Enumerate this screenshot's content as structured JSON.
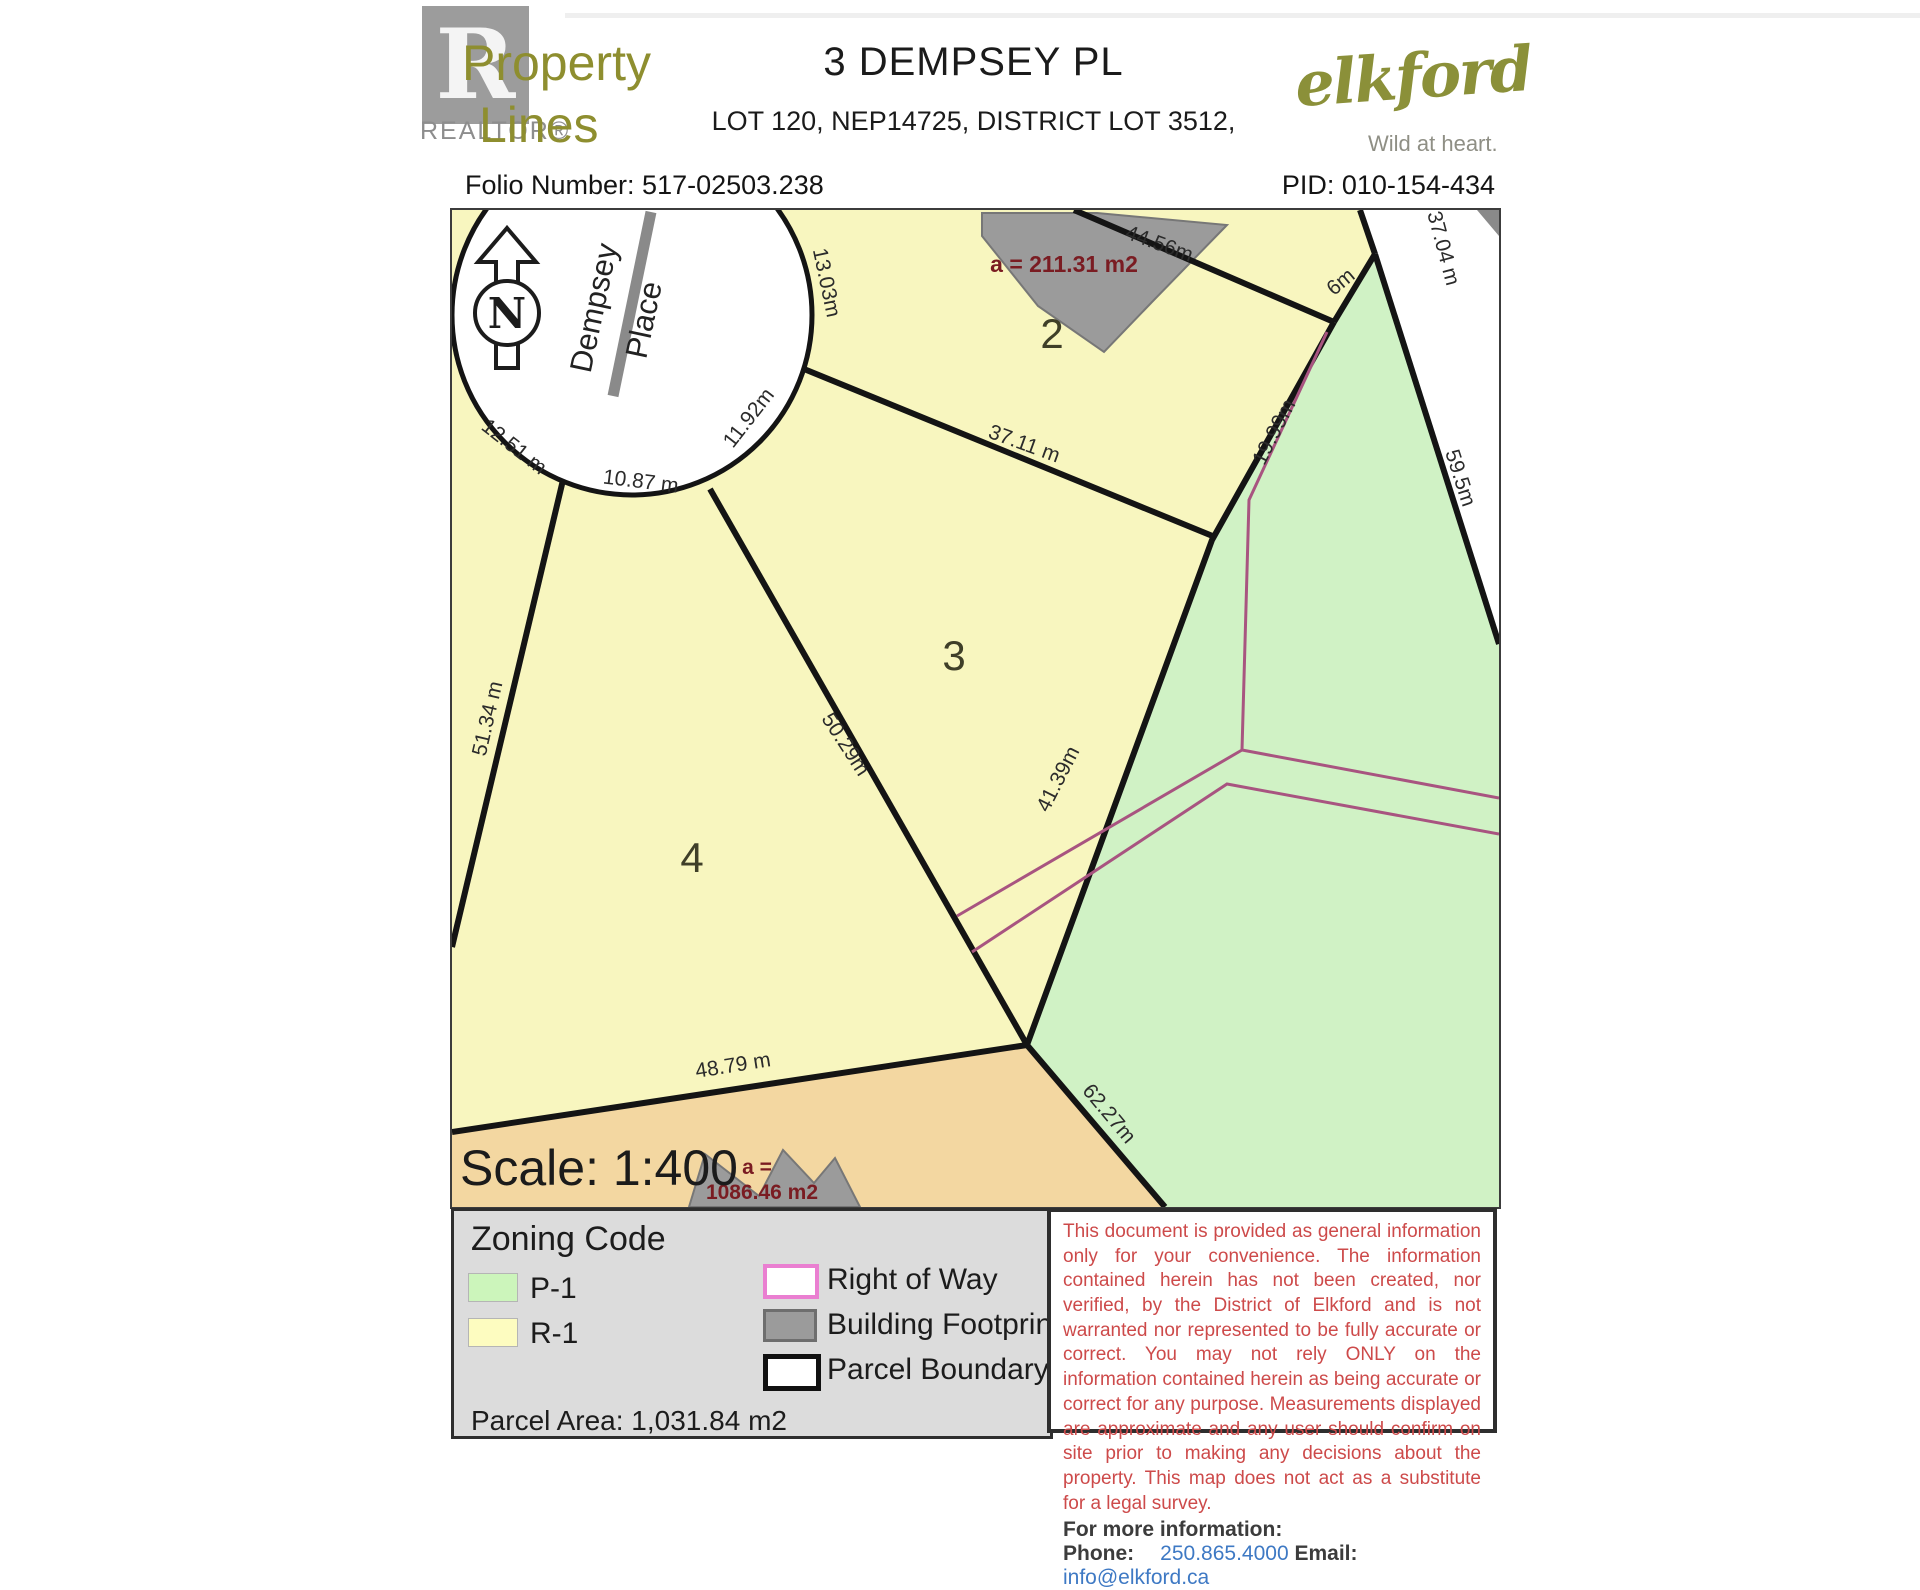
{
  "header": {
    "logo": {
      "brand_top": "Property",
      "brand_bottom": "Lines",
      "realtor_r": "R",
      "realtor_word": "REALTOR®"
    },
    "title": "3 DEMPSEY PL",
    "subtitle": "LOT 120, NEP14725, DISTRICT LOT 3512,",
    "folio": "Folio Number: 517-02503.238",
    "pid": "PID: 010-154-434",
    "municipal_logo": {
      "name": "elkford",
      "tagline": "Wild at heart."
    }
  },
  "map": {
    "north_letter": "N",
    "street_name_line1": "Dempsey",
    "street_name_line2": "Place",
    "scale_text": "Scale: 1:400",
    "parcel_numbers": {
      "p2": "2",
      "p3": "3",
      "p4": "4"
    },
    "building_areas": {
      "top": "a = 211.31 m2",
      "bottom_line1": "a =",
      "bottom_line2": "1086.46 m2"
    },
    "measurements": {
      "arc_1251": "12.51 m",
      "arc_1087": "10.87 m",
      "arc_1192": "11.92m",
      "arc_1303": "13.03m",
      "top_4456": "44.56m",
      "seg_6": "6m",
      "ne_3704": "37.04 m",
      "ne_595": "59.5m",
      "east_1999": "19.99m",
      "mid_3711": "37.11 m",
      "mid_5029": "50.29m",
      "east_4139": "41.39m",
      "west_5134": "51.34 m",
      "south_4879": "48.79 m",
      "se_6227": "62.27m"
    },
    "colors": {
      "zone_r1": "#f8f6bf",
      "zone_p1": "#d0f2c5",
      "unzoned_tan": "#f3d7a1",
      "right_of_way": "#a85480",
      "building": "#9b9b9b",
      "parcel_boundary": "#141414"
    }
  },
  "legend": {
    "zoning_title": "Zoning Code",
    "p1_label": "P-1",
    "r1_label": "R-1",
    "right_of_way_label": "Right of Way",
    "building_footprint_label": "Building Footprint",
    "parcel_boundary_label": "Parcel Boundary",
    "parcel_area": "Parcel Area: 1,031.84 m2"
  },
  "disclaimer": {
    "body": "This document is provided as general information only for your convenience. The information contained herein has not been created, nor verified, by the District of Elkford and is not warranted nor represented to be fully accurate or correct. You may not rely ONLY on the information contained herein as being accurate or correct for any purpose. Measurements displayed are approximate and any user should confirm on site prior to making any decisions about the property. This map does not act as a substitute for a legal survey.",
    "more_info": "For more information:",
    "phone_label": "Phone:",
    "phone_value": "250.865.4000",
    "email_label": "Email:",
    "email_value": "info@elkford.ca"
  }
}
